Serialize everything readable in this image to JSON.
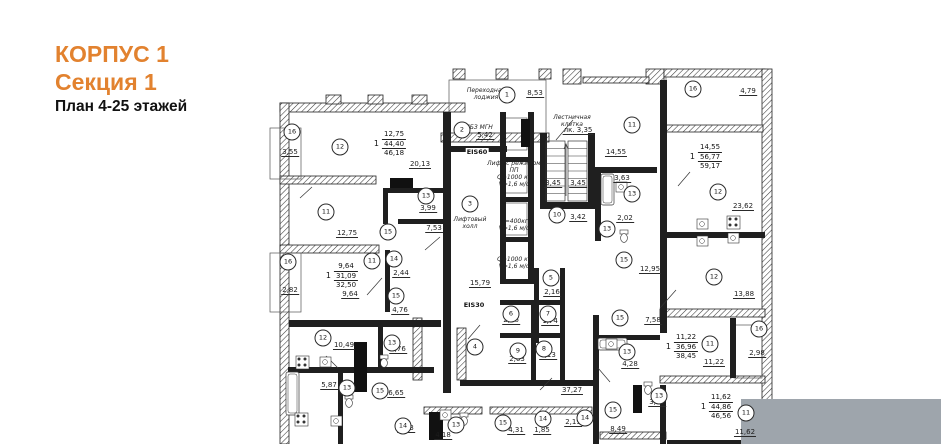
{
  "title": {
    "line1": "КОРПУС 1",
    "line2": "Секция 1",
    "line3": "План 4-25 этажей"
  },
  "colors": {
    "accent": "#e2822f",
    "ink": "#1c1c1c",
    "wall": "#1f1f1f",
    "hatch": "#3a3a3a",
    "gray_overlay": "#9ea5ac",
    "bg": "#ffffff"
  },
  "plan": {
    "room_markers": [
      [
        "16",
        292,
        132
      ],
      [
        "12",
        340,
        147
      ],
      [
        "2",
        462,
        130
      ],
      [
        "1",
        507,
        95
      ],
      [
        "11",
        632,
        125
      ],
      [
        "16",
        693,
        89
      ],
      [
        "12",
        718,
        192
      ],
      [
        "13",
        632,
        194
      ],
      [
        "10",
        557,
        215
      ],
      [
        "13",
        607,
        229
      ],
      [
        "3",
        470,
        204
      ],
      [
        "11",
        326,
        212
      ],
      [
        "16",
        288,
        262
      ],
      [
        "13",
        426,
        196
      ],
      [
        "15",
        388,
        232
      ],
      [
        "11",
        372,
        261
      ],
      [
        "14",
        394,
        259
      ],
      [
        "15",
        396,
        296
      ],
      [
        "15",
        624,
        260
      ],
      [
        "12",
        714,
        277
      ],
      [
        "16",
        759,
        329
      ],
      [
        "12",
        323,
        338
      ],
      [
        "13",
        392,
        343
      ],
      [
        "4",
        475,
        347
      ],
      [
        "5",
        551,
        278
      ],
      [
        "6",
        511,
        314
      ],
      [
        "7",
        548,
        314
      ],
      [
        "9",
        518,
        351
      ],
      [
        "8",
        544,
        349
      ],
      [
        "13",
        347,
        388
      ],
      [
        "15",
        380,
        391
      ],
      [
        "15",
        620,
        318
      ],
      [
        "13",
        627,
        352
      ],
      [
        "11",
        710,
        344
      ],
      [
        "14",
        403,
        426
      ],
      [
        "13",
        456,
        425
      ],
      [
        "15",
        503,
        423
      ],
      [
        "14",
        543,
        419
      ],
      [
        "14",
        585,
        418
      ],
      [
        "13",
        659,
        396
      ],
      [
        "15",
        613,
        410
      ],
      [
        "11",
        746,
        413
      ]
    ],
    "dimensions": [
      [
        "3,55",
        290,
        156
      ],
      [
        "20,13",
        420,
        168
      ],
      [
        "5,42",
        485,
        139
      ],
      [
        "8,53",
        535,
        97
      ],
      [
        "лк. 3,35",
        578,
        134
      ],
      [
        "3,45",
        553,
        187
      ],
      [
        "3,45",
        578,
        187
      ],
      [
        "14,55",
        616,
        156
      ],
      [
        "3,63",
        622,
        182
      ],
      [
        "4,79",
        748,
        95
      ],
      [
        "23,62",
        743,
        210
      ],
      [
        "2,02",
        625,
        222
      ],
      [
        "3,42",
        578,
        221
      ],
      [
        "12,75",
        347,
        237
      ],
      [
        "3,99",
        428,
        212
      ],
      [
        "7,53",
        434,
        232
      ],
      [
        "2,82",
        290,
        294
      ],
      [
        "2,44",
        401,
        277
      ],
      [
        "9,64",
        350,
        298
      ],
      [
        "15,79",
        480,
        287
      ],
      [
        "12,95",
        650,
        273
      ],
      [
        "2,16",
        552,
        296
      ],
      [
        "4,76",
        400,
        314
      ],
      [
        "13,88",
        744,
        298
      ],
      [
        "10,49",
        344,
        349
      ],
      [
        "3,76",
        398,
        353
      ],
      [
        "2,26",
        511,
        324
      ],
      [
        "1,74",
        550,
        325
      ],
      [
        "2,63",
        517,
        363
      ],
      [
        "2,13",
        548,
        359
      ],
      [
        "7,58",
        653,
        324
      ],
      [
        "4,28",
        630,
        368
      ],
      [
        "5,87",
        329,
        389
      ],
      [
        "6,65",
        396,
        397
      ],
      [
        "37,27",
        572,
        394
      ],
      [
        "2,98",
        757,
        357
      ],
      [
        "11,22",
        714,
        366
      ],
      [
        "3,86",
        657,
        406
      ],
      [
        "2,83",
        406,
        432
      ],
      [
        "4,18",
        443,
        439
      ],
      [
        "4,31",
        516,
        434
      ],
      [
        "1,85",
        542,
        434
      ],
      [
        "2,19",
        573,
        426
      ],
      [
        "8,49",
        618,
        433
      ],
      [
        "11,62",
        745,
        436
      ]
    ],
    "apartments": [
      {
        "num": "1",
        "vals": [
          "12,75",
          "44,40",
          "46,18"
        ],
        "x": 390,
        "y": 130
      },
      {
        "num": "1",
        "vals": [
          "14,55",
          "56,77",
          "59,17"
        ],
        "x": 706,
        "y": 143
      },
      {
        "num": "1",
        "vals": [
          "9,64",
          "31,09",
          "32,50"
        ],
        "x": 342,
        "y": 262
      },
      {
        "num": "1",
        "vals": [
          "11,22",
          "36,96",
          "38,45"
        ],
        "x": 682,
        "y": 333
      },
      {
        "num": "1",
        "vals": [
          "11,62",
          "44,86",
          "46,56"
        ],
        "x": 717,
        "y": 393
      }
    ],
    "labels": [
      {
        "t": "Переходная\nлоджия",
        "x": 486,
        "y": 87
      },
      {
        "t": "Лестничная\nклетка",
        "x": 572,
        "y": 114
      },
      {
        "t": "ЛБЗ МГН",
        "x": 479,
        "y": 124
      },
      {
        "t": "Лифтовый\nхолл",
        "x": 470,
        "y": 216
      },
      {
        "t": "Лифт с режимом\nПП\nQ=1000 кг\nV=1,6 м/с",
        "x": 514,
        "y": 160
      },
      {
        "t": "Q=400кг\nV=1,6 м/с",
        "x": 514,
        "y": 218
      },
      {
        "t": "Q=1000 кг\nV=1,6 м/с",
        "x": 514,
        "y": 256
      }
    ],
    "fire_labels": [
      {
        "t": "EIS60",
        "x": 477,
        "y": 152
      },
      {
        "t": "EIS30",
        "x": 474,
        "y": 305
      }
    ],
    "geometry": {
      "ext_walls": [
        [
          280,
          103,
          185,
          9
        ],
        [
          280,
          103,
          9,
          341
        ],
        [
          326,
          95,
          15,
          9
        ],
        [
          368,
          95,
          15,
          9
        ],
        [
          412,
          95,
          15,
          9
        ],
        [
          441,
          133,
          108,
          9
        ],
        [
          453,
          69,
          12,
          10
        ],
        [
          496,
          69,
          12,
          10
        ],
        [
          539,
          69,
          12,
          10
        ],
        [
          563,
          69,
          18,
          15
        ],
        [
          646,
          69,
          18,
          15
        ],
        [
          583,
          77,
          66,
          6
        ],
        [
          664,
          69,
          101,
          8
        ],
        [
          762,
          69,
          10,
          375
        ],
        [
          664,
          125,
          99,
          7
        ],
        [
          280,
          176,
          96,
          8
        ],
        [
          280,
          245,
          99,
          8
        ],
        [
          660,
          309,
          105,
          8
        ],
        [
          660,
          376,
          105,
          7
        ],
        [
          413,
          318,
          9,
          62
        ],
        [
          457,
          328,
          9,
          52
        ],
        [
          424,
          407,
          58,
          7
        ],
        [
          490,
          407,
          102,
          7
        ],
        [
          600,
          432,
          66,
          7
        ]
      ],
      "int_walls": [
        [
          443,
          112,
          8,
          281
        ],
        [
          451,
          146,
          56,
          6
        ],
        [
          500,
          112,
          6,
          172
        ],
        [
          528,
          112,
          6,
          172
        ],
        [
          500,
          157,
          34,
          5
        ],
        [
          500,
          197,
          34,
          5
        ],
        [
          500,
          237,
          34,
          5
        ],
        [
          500,
          279,
          34,
          5
        ],
        [
          540,
          133,
          7,
          76
        ],
        [
          588,
          133,
          7,
          76
        ],
        [
          540,
          202,
          55,
          7
        ],
        [
          595,
          167,
          62,
          6
        ],
        [
          595,
          173,
          6,
          68
        ],
        [
          660,
          80,
          7,
          253
        ],
        [
          666,
          232,
          99,
          6
        ],
        [
          289,
          320,
          152,
          7
        ],
        [
          288,
          367,
          146,
          6
        ],
        [
          378,
          325,
          5,
          44
        ],
        [
          338,
          373,
          5,
          71
        ],
        [
          383,
          188,
          60,
          5
        ],
        [
          383,
          188,
          5,
          36
        ],
        [
          398,
          219,
          47,
          5
        ],
        [
          385,
          250,
          5,
          62
        ],
        [
          534,
          268,
          5,
          75
        ],
        [
          560,
          268,
          5,
          112
        ],
        [
          500,
          300,
          60,
          5
        ],
        [
          500,
          333,
          60,
          5
        ],
        [
          531,
          300,
          5,
          80
        ],
        [
          460,
          380,
          135,
          6
        ],
        [
          593,
          315,
          6,
          129
        ],
        [
          598,
          335,
          62,
          5
        ],
        [
          660,
          385,
          6,
          59
        ],
        [
          730,
          318,
          6,
          60
        ],
        [
          667,
          440,
          98,
          4
        ]
      ],
      "thin_rects": [
        [
          270,
          128,
          31,
          51
        ],
        [
          270,
          253,
          31,
          59
        ],
        [
          449,
          80,
          97,
          53
        ],
        [
          666,
          77,
          96,
          48
        ],
        [
          734,
          325,
          28,
          53
        ],
        [
          505,
          118,
          22,
          32
        ],
        [
          505,
          161,
          22,
          32
        ],
        [
          505,
          203,
          22,
          32
        ]
      ],
      "black_rects": [
        [
          390,
          178,
          23,
          10
        ],
        [
          354,
          342,
          13,
          50
        ],
        [
          429,
          412,
          14,
          28
        ],
        [
          521,
          119,
          9,
          28
        ],
        [
          633,
          385,
          9,
          28
        ]
      ],
      "lines": [
        [
          367,
          295,
          382,
          278
        ],
        [
          556,
          140,
          573,
          120
        ],
        [
          678,
          186,
          690,
          172
        ],
        [
          660,
          308,
          676,
          290
        ],
        [
          326,
          356,
          338,
          368
        ],
        [
          468,
          339,
          480,
          325
        ],
        [
          610,
          382,
          598,
          368
        ],
        [
          540,
          390,
          552,
          378
        ],
        [
          425,
          250,
          440,
          237
        ],
        [
          300,
          198,
          312,
          187
        ]
      ],
      "stairs": {
        "flights": [
          [
            546,
            141,
            19,
            60
          ],
          [
            568,
            141,
            19,
            60
          ]
        ],
        "treads": 8,
        "arrow": [
          566,
          196,
          566,
          144
        ]
      },
      "tubs": [
        [
          601,
          174,
          13,
          31
        ],
        [
          598,
          338,
          29,
          12
        ],
        [
          286,
          372,
          13,
          43
        ]
      ],
      "wcs": [
        [
          349,
          401
        ],
        [
          464,
          419
        ],
        [
          624,
          236
        ],
        [
          648,
          388
        ],
        [
          384,
          361
        ]
      ],
      "sinks": [
        [
          325,
          362
        ],
        [
          445,
          415
        ],
        [
          611,
          344
        ],
        [
          621,
          187
        ],
        [
          702,
          224
        ],
        [
          702,
          241
        ],
        [
          733,
          238
        ],
        [
          336,
          421
        ]
      ],
      "burners": [
        [
          302,
          362
        ],
        [
          733,
          222
        ],
        [
          301,
          419
        ]
      ],
      "gray_box": [
        741,
        399,
        200,
        45
      ]
    }
  }
}
